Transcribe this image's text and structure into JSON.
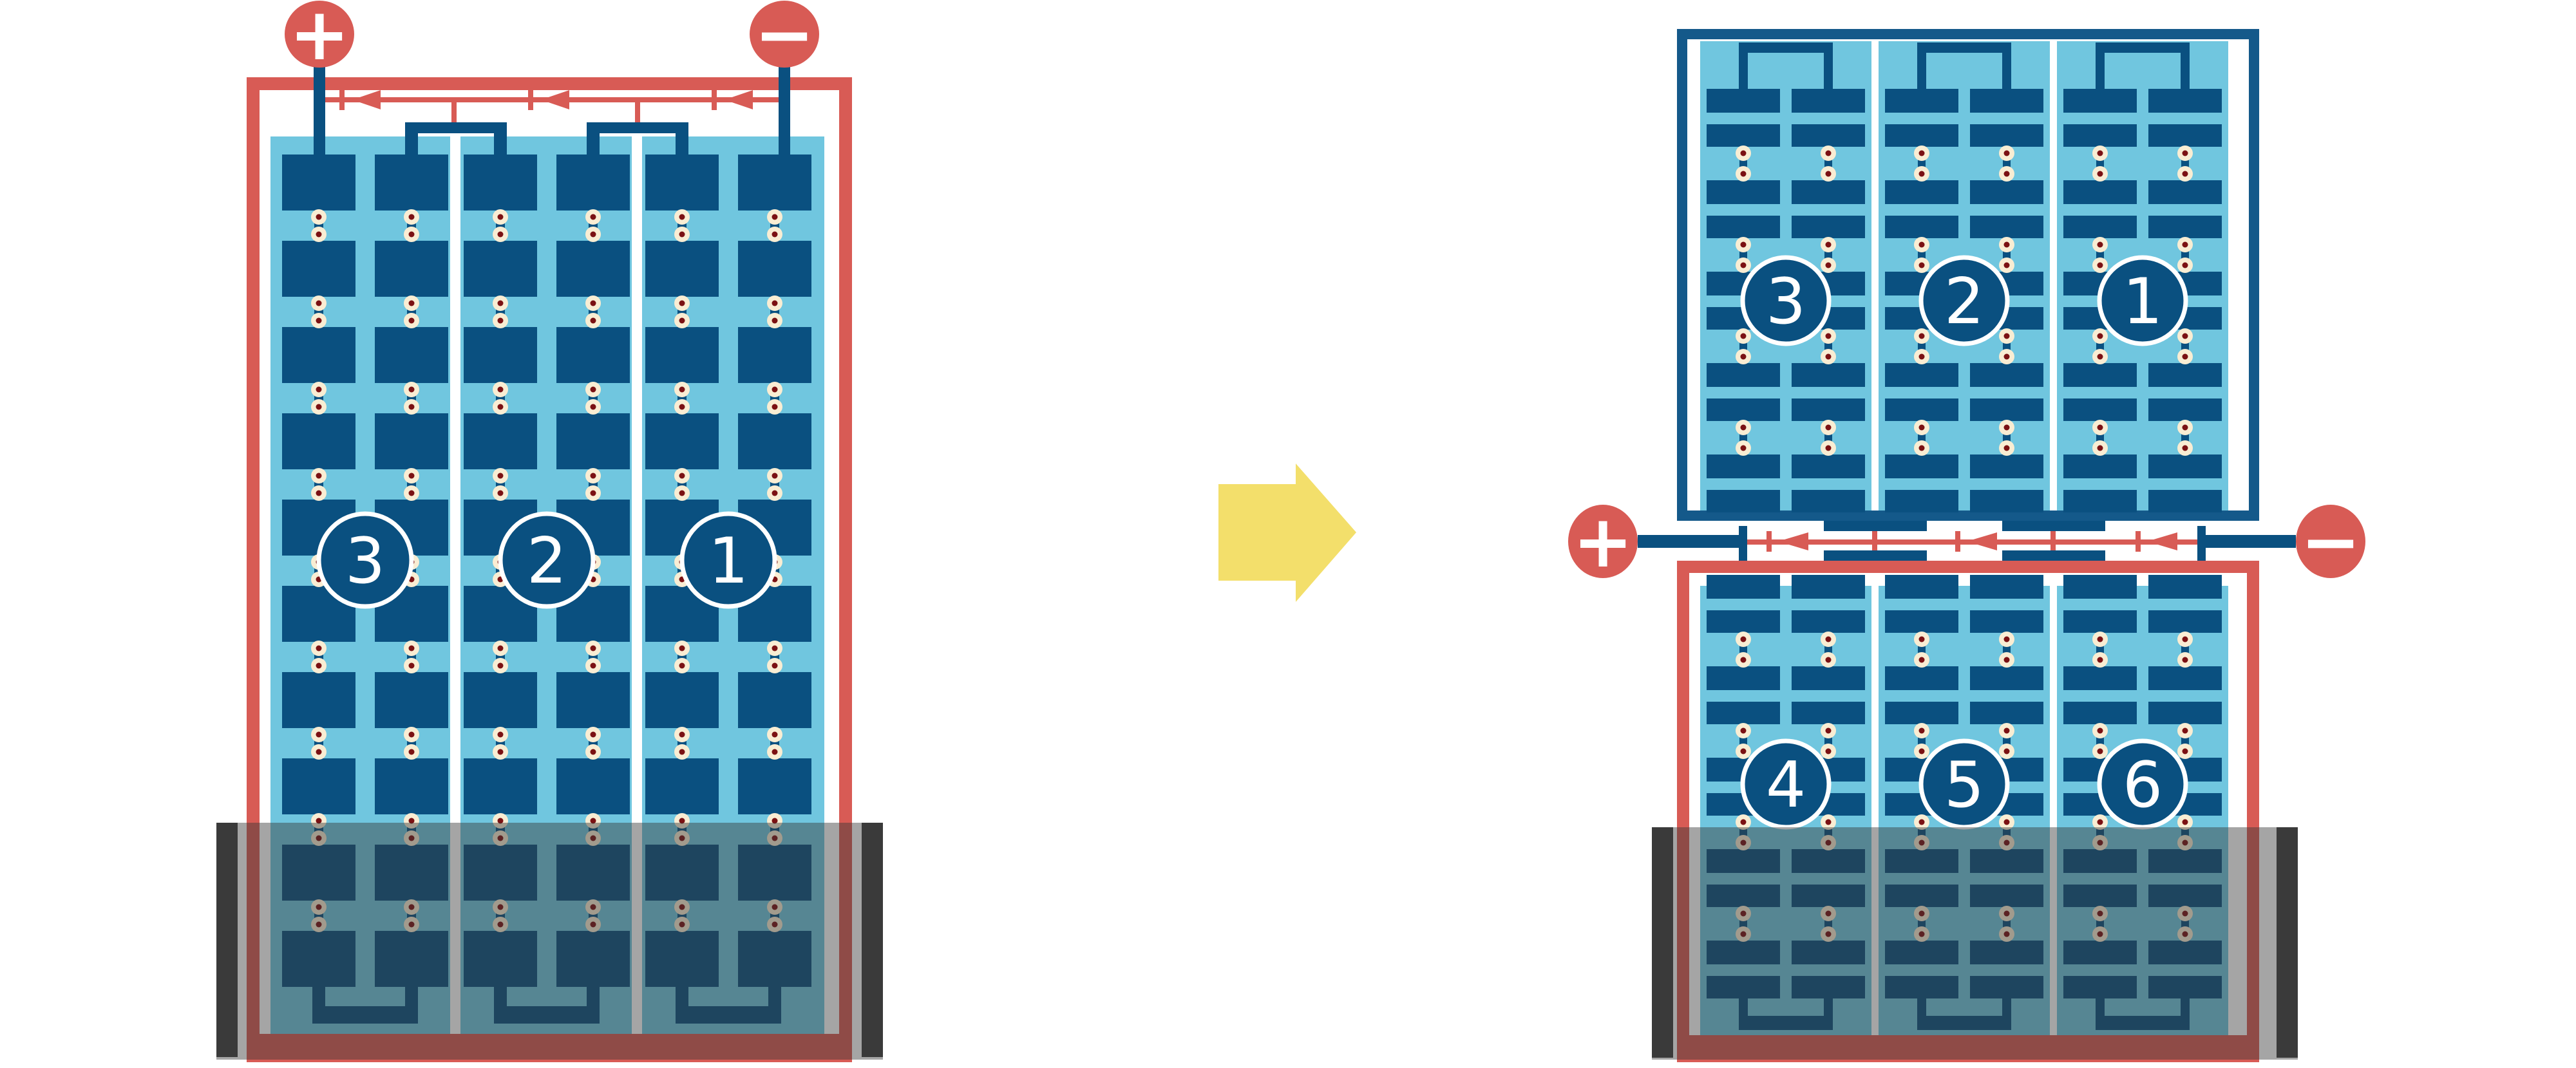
{
  "colors": {
    "red": "#D85B55",
    "dark_blue": "#0A5080",
    "frame_blue": "#14598A",
    "light_blue": "#70C6DF",
    "cream": "#F9EDD3",
    "maroon": "#7B1113",
    "black_bar": "#3C3C3C",
    "water_gray": "rgba(55,55,55,0.45)",
    "yellow": "#F3DF6B",
    "white": "#FFFFFF"
  },
  "left_panel": {
    "terminals": {
      "positive": "+",
      "negative": "−"
    },
    "strings": [
      "3",
      "2",
      "1"
    ]
  },
  "right_top_panel": {
    "strings": [
      "3",
      "2",
      "1"
    ]
  },
  "right_bottom_panel": {
    "strings": [
      "4",
      "5",
      "6"
    ]
  },
  "right_terminals": {
    "positive": "+",
    "negative": "−"
  },
  "transform_arrow": {
    "direction": "right"
  }
}
